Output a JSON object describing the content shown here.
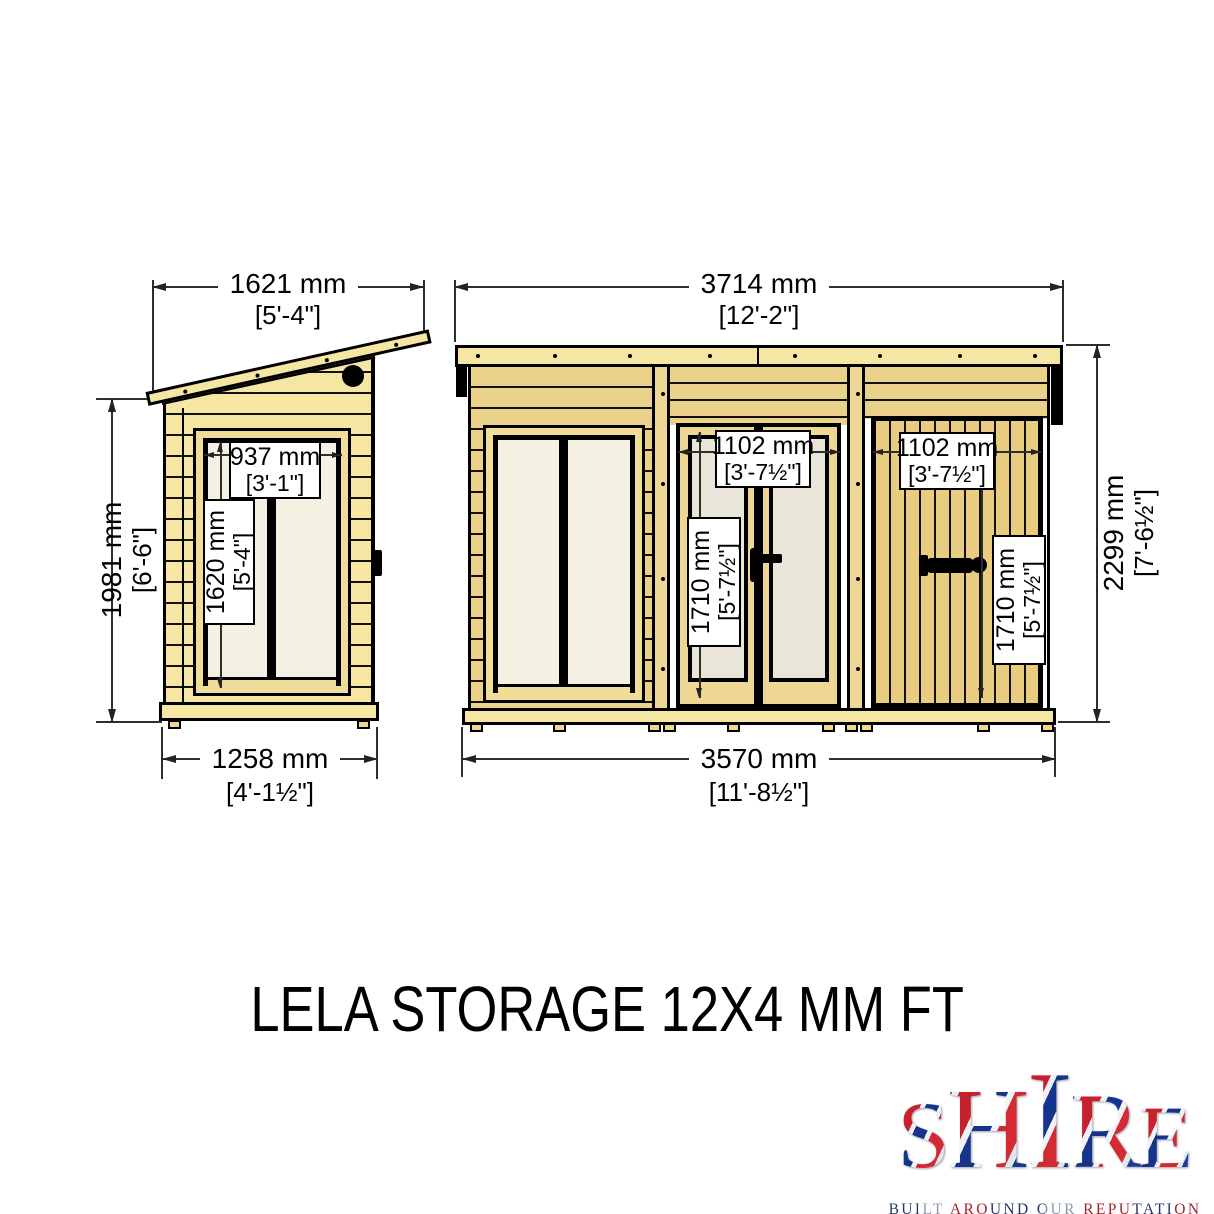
{
  "title": "LELA STORAGE 12X4 MM FT",
  "side": {
    "roof_width_mm": "1621 mm",
    "roof_width_ft": "[5'-4\"]",
    "height_mm": "1981 mm",
    "height_ft": "[6'-6\"]",
    "window_width_mm": "937 mm",
    "window_width_ft": "[3'-1\"]",
    "window_height_mm": "1620 mm",
    "window_height_ft": "[5'-4\"]",
    "base_width_mm": "1258 mm",
    "base_width_ft": "[4'-1½\"]"
  },
  "front": {
    "width_mm": "3714 mm",
    "width_ft": "[12'-2\"]",
    "height_mm": "2299 mm",
    "height_ft": "[7'-6½\"]",
    "glazed_door_width_mm": "1102 mm",
    "glazed_door_width_ft": "[3'-7½\"]",
    "glazed_door_height_mm": "1710 mm",
    "glazed_door_height_ft": "[5'-7½\"]",
    "store_door_width_mm": "1102 mm",
    "store_door_width_ft": "[3'-7½\"]",
    "store_door_height_mm": "1710 mm",
    "store_door_height_ft": "[5'-7½\"]",
    "base_width_mm": "3570 mm",
    "base_width_ft": "[11'-8½\"]"
  },
  "logo": {
    "letters": [
      "S",
      "H",
      "I",
      "R",
      "E"
    ],
    "tagline": "BUILT AROUND OUR REPUTATION"
  },
  "colors": {
    "wood_pale": "#f5e6a3",
    "wood_tan": "#ebd28b",
    "glass": "#f2efe2",
    "outline": "#000000",
    "dimension_line": "#2e2e2e",
    "logo_red": "#c8202c",
    "logo_blue": "#16348c"
  }
}
